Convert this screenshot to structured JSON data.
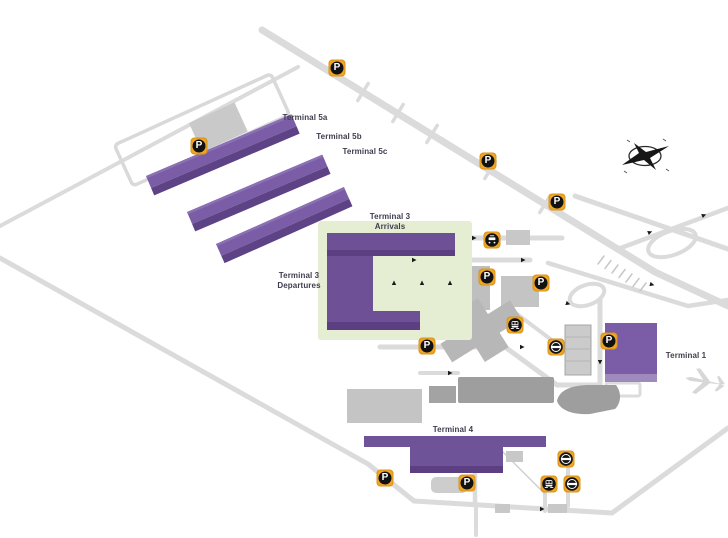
{
  "map": {
    "terminals": {
      "t5a": "Terminal 5a",
      "t5b": "Terminal 5b",
      "t5c": "Terminal 5c",
      "t3_arrivals_l1": "Terminal 3",
      "t3_arrivals_l2": "Arrivals",
      "t3_departures_l1": "Terminal 3",
      "t3_departures_l2": "Departures",
      "t1": "Terminal 1",
      "t4": "Terminal 4"
    },
    "icons": {
      "parking": "P",
      "bus": "bus-station",
      "train": "rail-station",
      "underground": "underground-station",
      "compass": "compass-rose"
    },
    "colors": {
      "terminal_fill": "#6F5399",
      "terminal_fill_light": "#7A5DA6",
      "terminal_shade": "#5B3F82",
      "terminal_highlight": "#9E8ABC",
      "green_zone": "#E5EED3",
      "road": "#DBDBDB",
      "building_gray": "#BDBDBD",
      "building_gray_dark": "#9E9E9E",
      "marker_yellow": "#F0A622",
      "label_text": "#403C4D"
    }
  }
}
